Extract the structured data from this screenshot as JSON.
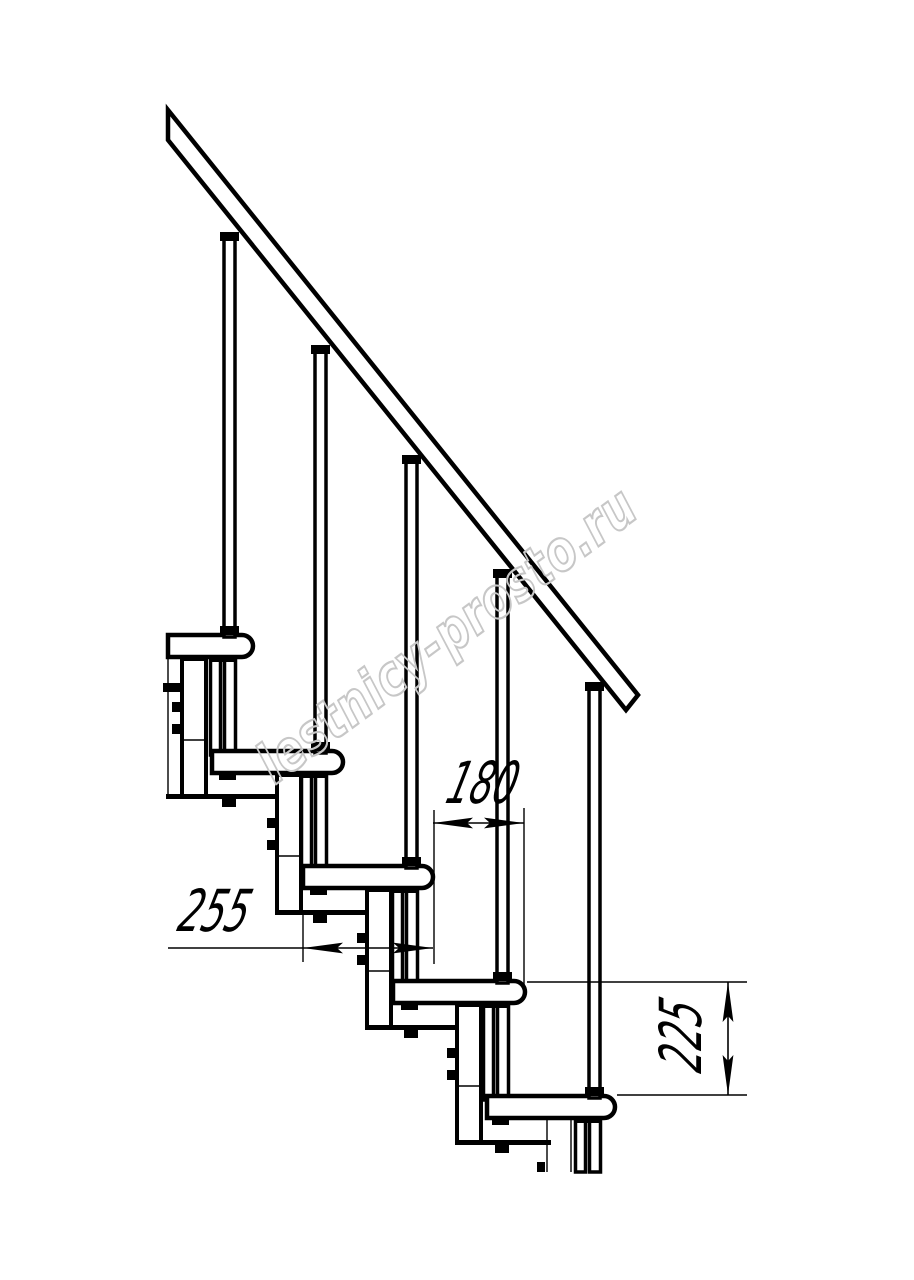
{
  "page": {
    "background": "#ffffff",
    "line_color": "#000000"
  },
  "drawing": {
    "subject": "modular staircase side elevation",
    "steps_visible": 5,
    "balusters_visible": 5
  },
  "dimensions": {
    "tread_depth": {
      "label": "255"
    },
    "step_run": {
      "label": "180"
    },
    "step_rise": {
      "label": "225"
    }
  },
  "watermark": {
    "text": "lestnicy-prosto.ru",
    "color": "#c7c7c7"
  }
}
